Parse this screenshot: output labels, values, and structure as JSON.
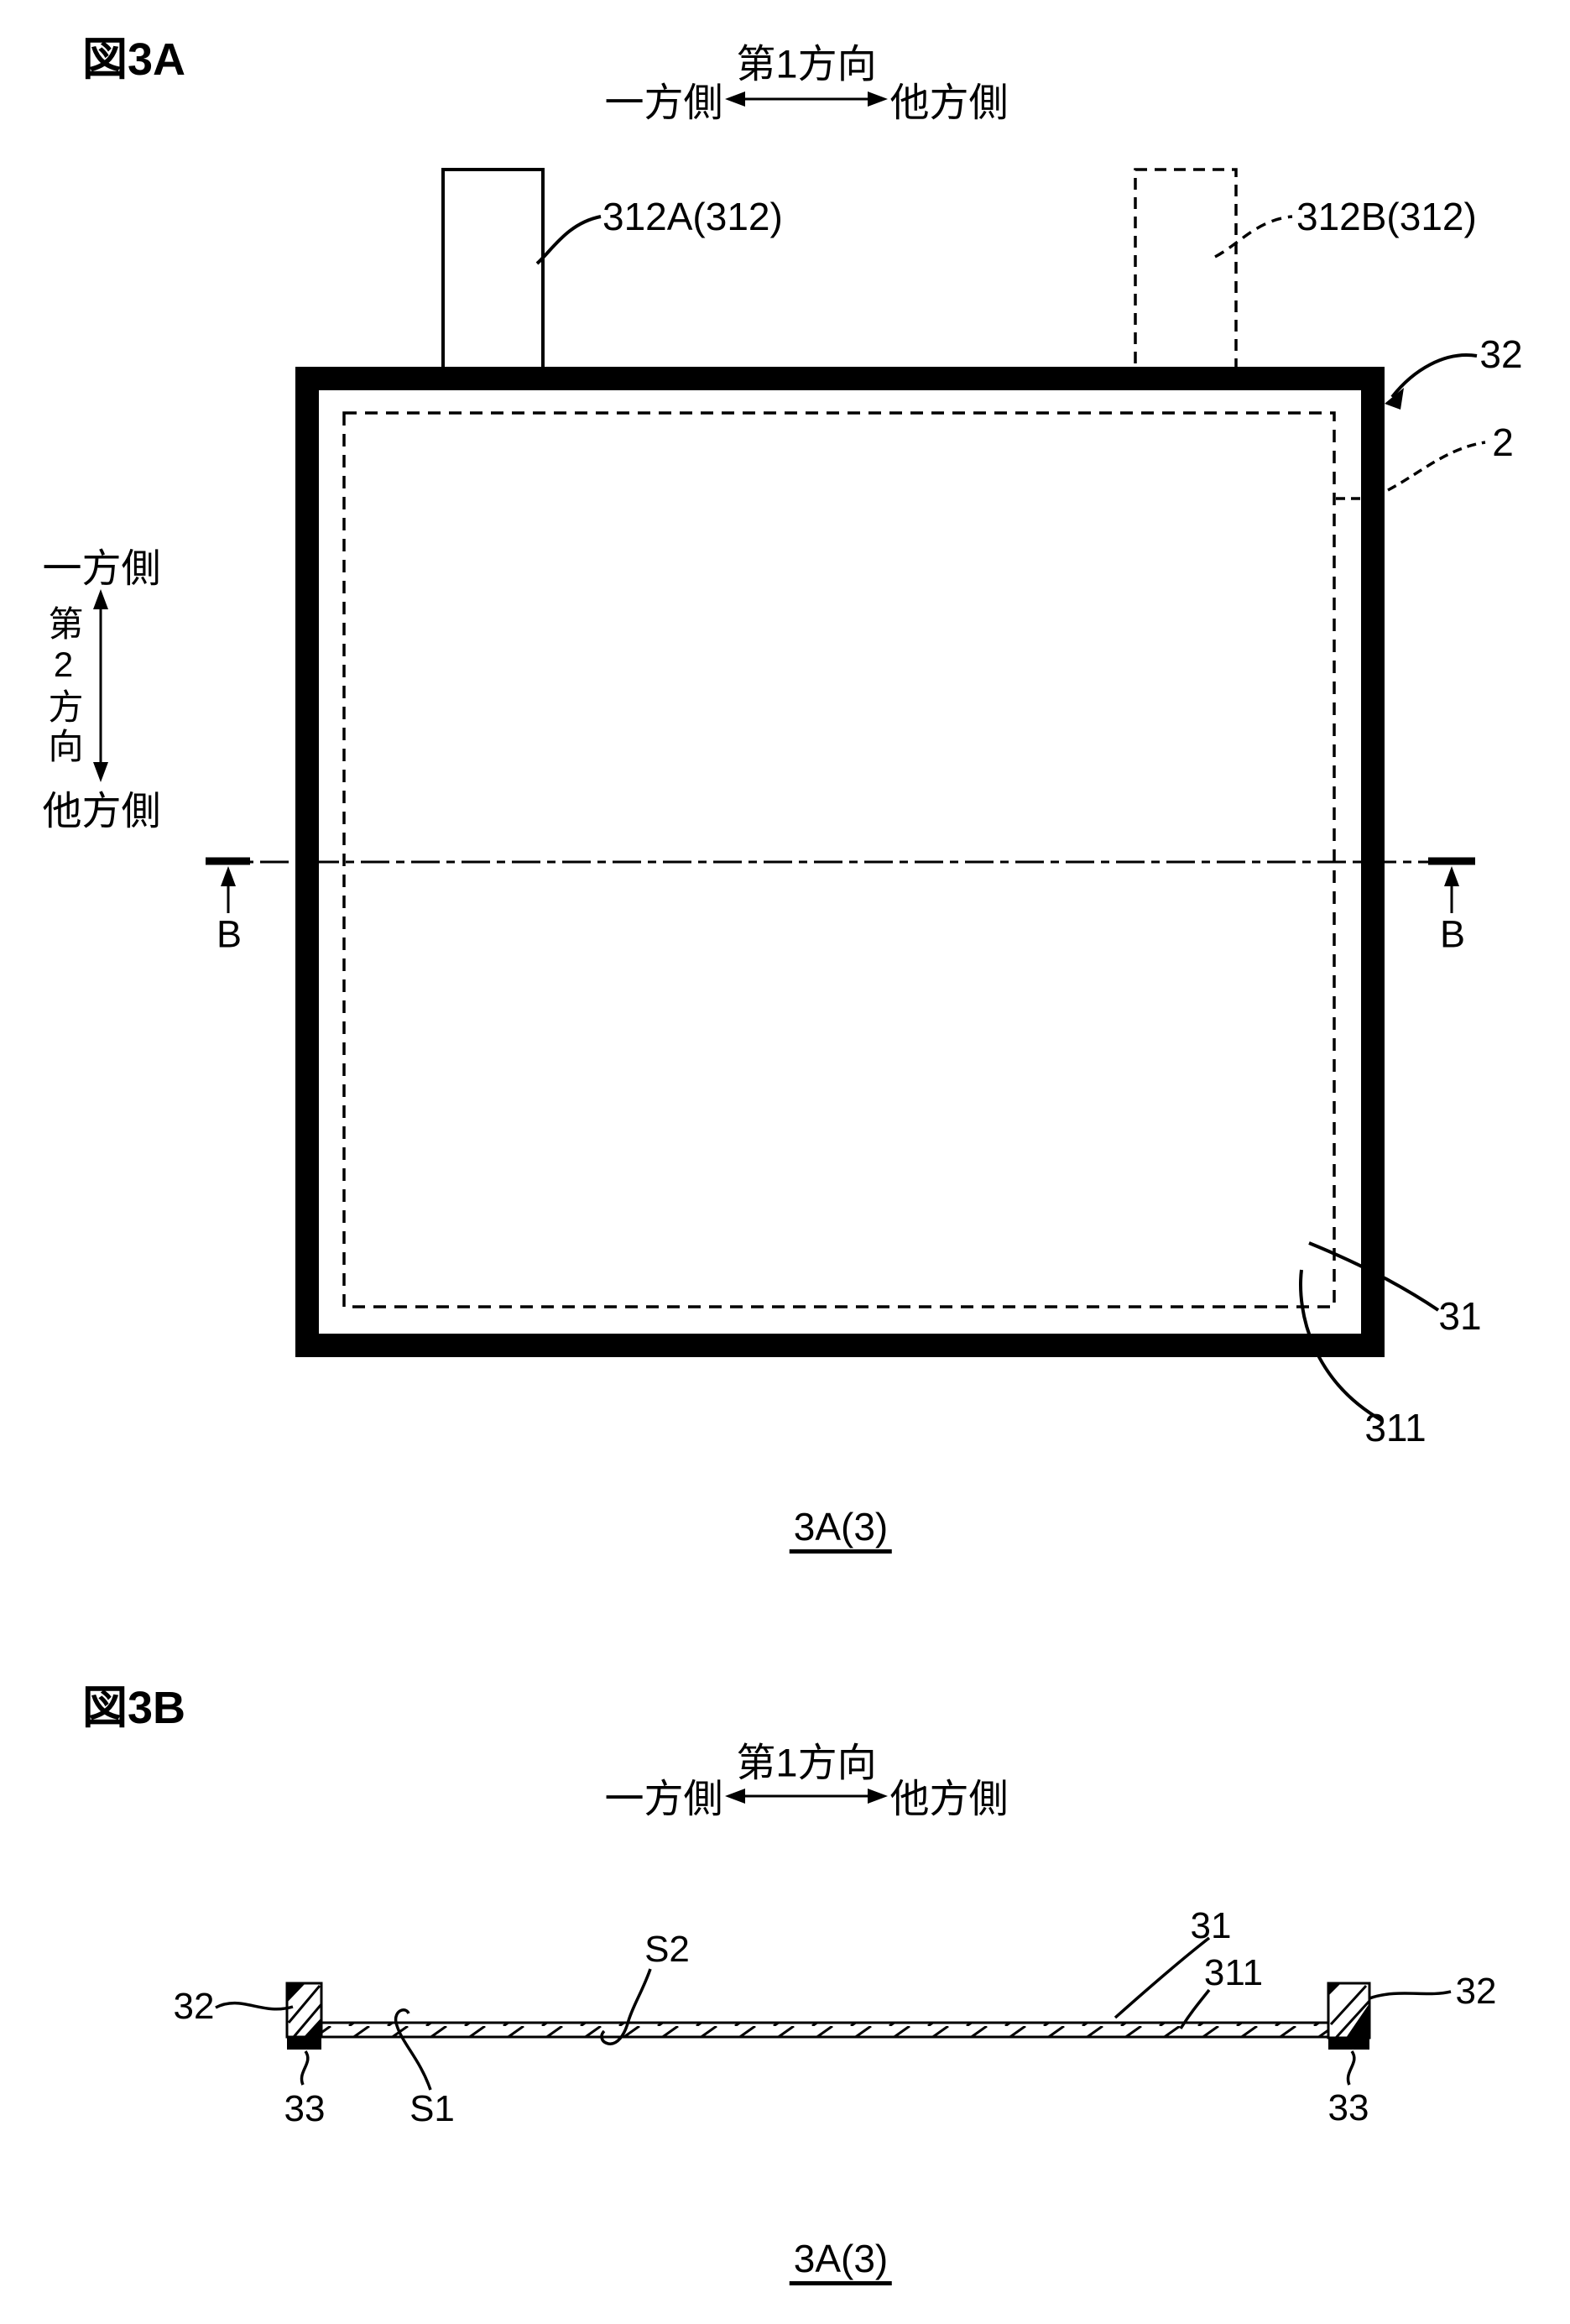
{
  "ink_color": "#000000",
  "figure_a": {
    "title": "図3A",
    "direction_h": {
      "axis_label": "第1方向",
      "left_label": "一方側",
      "right_label": "他方側"
    },
    "direction_v": {
      "axis_label": "第2方向",
      "top_label": "一方側",
      "bottom_label": "他方側"
    },
    "ref_labels": {
      "tab_a": "312A(312)",
      "tab_b": "312B(312)",
      "frame": "32",
      "electrode_body": "2",
      "sheet": "31",
      "sheet_edge": "311",
      "section_b_left": "B",
      "section_b_right": "B"
    },
    "caption": "3A(3)"
  },
  "figure_b": {
    "title": "図3B",
    "direction_h": {
      "axis_label": "第1方向",
      "left_label": "一方側",
      "right_label": "他方側"
    },
    "ref_labels": {
      "frame_left": "32",
      "frame_right": "32",
      "adhesive_left": "33",
      "adhesive_right": "33",
      "surface_s1": "S1",
      "surface_s2": "S2",
      "sheet": "31",
      "sheet_edge": "311"
    },
    "caption": "3A(3)"
  }
}
